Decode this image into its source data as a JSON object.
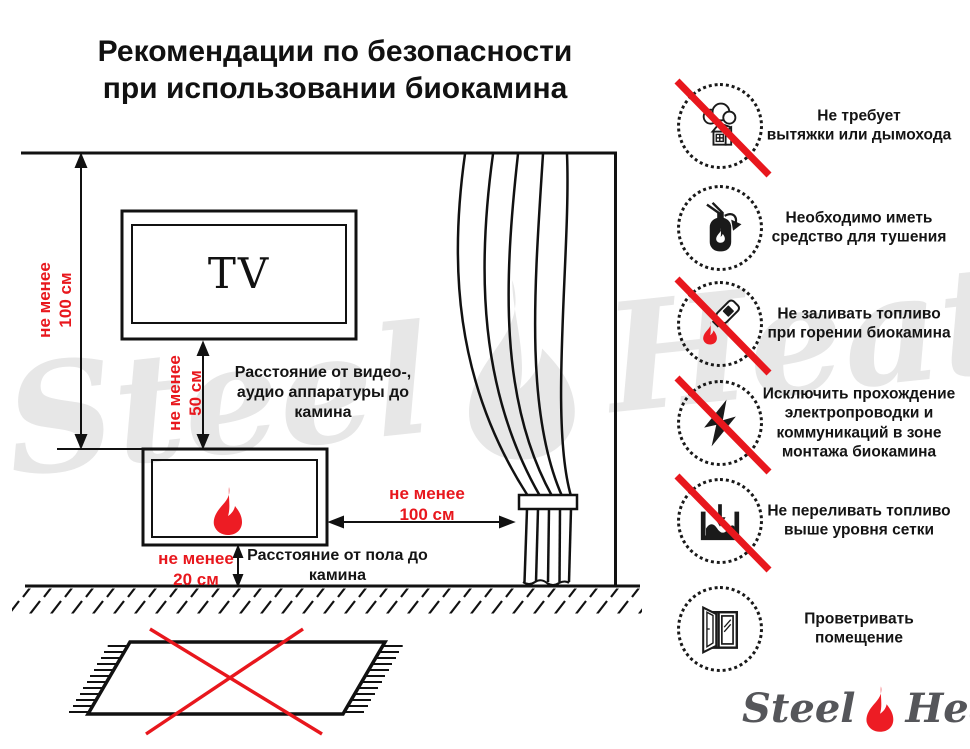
{
  "title": {
    "text": "Рекомендации по безопасности\nпри использовании биокамина"
  },
  "colors": {
    "accent_red": "#e8171d",
    "flame_red": "#ed1c24",
    "ink": "#141414",
    "watermark_gray": "#e7e7e7",
    "logo_gray": "#55565a"
  },
  "diagram": {
    "tv_label": "TV",
    "wall_distance": "не менее\n100 см",
    "tv_distance": "не менее\n50 см",
    "curtain_distance": "не менее\n100 см",
    "floor_distance": "не менее\n20 см",
    "av_note": "Расстояние от видео-,\nаудио аппаратуры до\nкамина",
    "floor_note": "Расстояние от пола до\nкамина"
  },
  "rules": [
    {
      "icon": "no-chimney-icon",
      "crossed": true,
      "text": "Не требует\nвытяжки или дымохода"
    },
    {
      "icon": "extinguisher-icon",
      "crossed": false,
      "text": "Необходимо иметь\nсредство для тушения"
    },
    {
      "icon": "no-refuel-while-burning-icon",
      "crossed": true,
      "text": "Не заливать топливо\nпри горении биокамина"
    },
    {
      "icon": "no-electrical-wiring-icon",
      "crossed": true,
      "text": "Исключить прохождение\nэлектропроводки и\nкоммуникаций в зоне\nмонтажа биокамина"
    },
    {
      "icon": "no-overfill-icon",
      "crossed": true,
      "text": "Не переливать топливо\nвыше уровня сетки"
    },
    {
      "icon": "ventilate-room-icon",
      "crossed": false,
      "text": "Проветривать\nпомещение"
    }
  ],
  "watermark": {
    "left": "Steel",
    "right": "Heat"
  },
  "logo": {
    "left": "Steel",
    "right": "Heat"
  }
}
